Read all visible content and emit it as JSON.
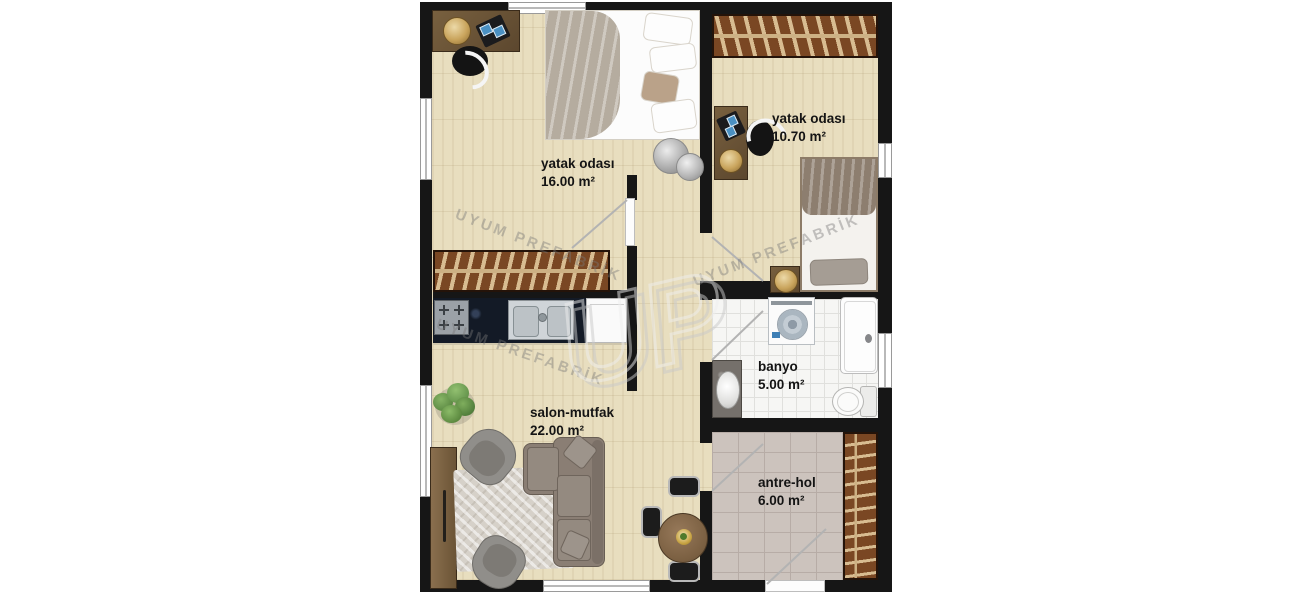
{
  "watermark": {
    "text": "UYUM PREFABRİK",
    "logo_text": "UP"
  },
  "rooms": [
    {
      "id": "bedroom-1",
      "label": "yatak odası",
      "area": "16.00 m²"
    },
    {
      "id": "bedroom-2",
      "label": "yatak odası",
      "area": "10.70 m²"
    },
    {
      "id": "living-kitchen",
      "label": "salon-mutfak",
      "area": "22.00 m²"
    },
    {
      "id": "bathroom",
      "label": "banyo",
      "area": "5.00 m²"
    },
    {
      "id": "entrance-hall",
      "label": "antre-hol",
      "area": "6.00 m²"
    }
  ],
  "colors": {
    "wall": "#161616",
    "wood_floor": "#e8debf",
    "closet_brown": "#7a4723",
    "closet_stripe": "#d8bc91",
    "bath_tile": "#f6f6f4",
    "hall_tile": "#ccc3bd",
    "counter_dark": "#131a26",
    "accent_gold": "#c9a45c"
  }
}
